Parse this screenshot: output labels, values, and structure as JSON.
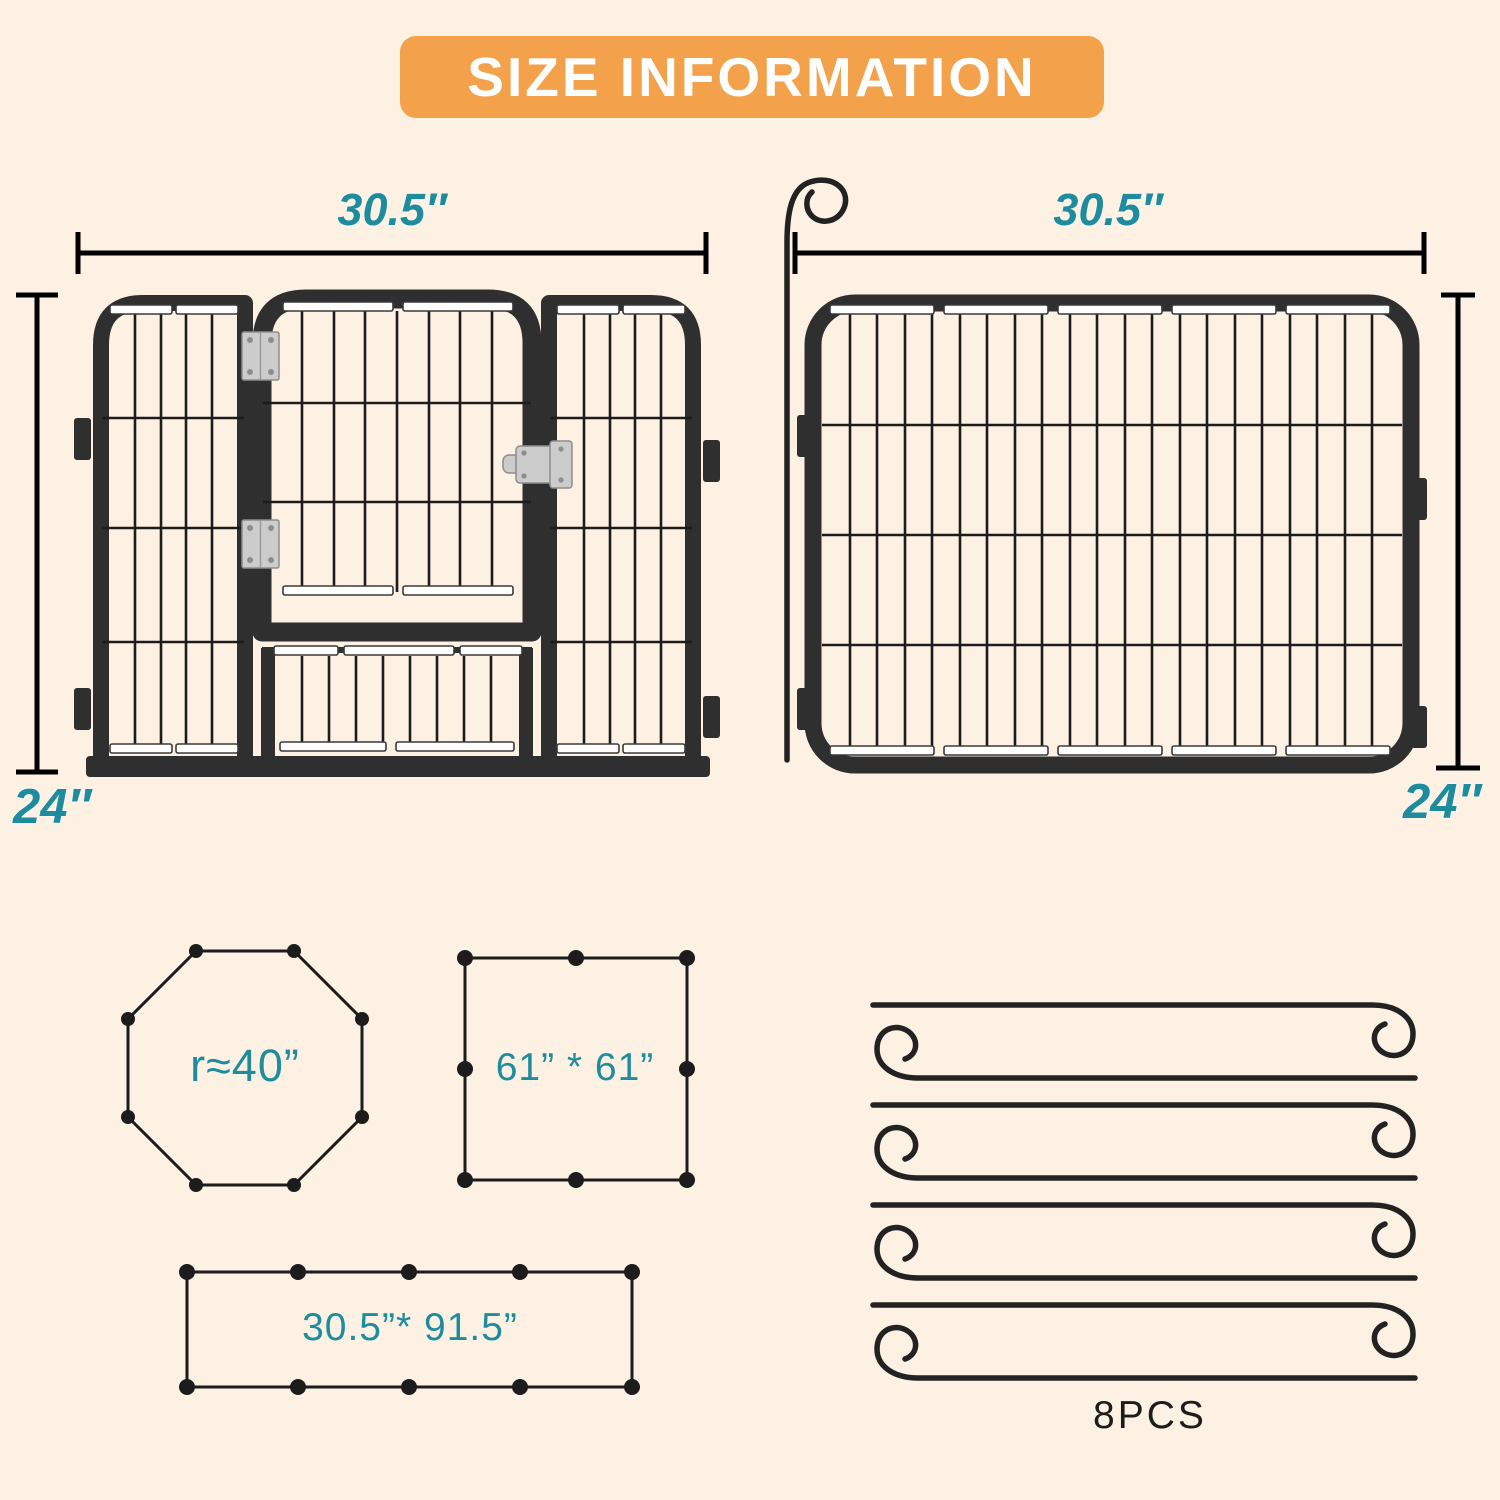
{
  "banner": {
    "title": "SIZE INFORMATION"
  },
  "colors": {
    "background": "#FCF1E3",
    "banner_bg": "#F3A24B",
    "banner_text": "#FFFFFF",
    "accent_teal": "#1F8C9D",
    "frame_dark": "#2F2F2F",
    "line_black": "#1C1C1C",
    "hardware_silver": "#CCCCCC"
  },
  "panels": {
    "door_panel": {
      "width_label": "30.5″",
      "height_label": "24″"
    },
    "fence_panel": {
      "width_label": "30.5″",
      "height_label": "24″"
    }
  },
  "layouts": {
    "octagon": {
      "label": "r≈40”"
    },
    "square": {
      "label": "61” * 61”"
    },
    "rectangle": {
      "label": "30.5”* 91.5”"
    }
  },
  "stakes": {
    "count_label": "8PCS"
  }
}
